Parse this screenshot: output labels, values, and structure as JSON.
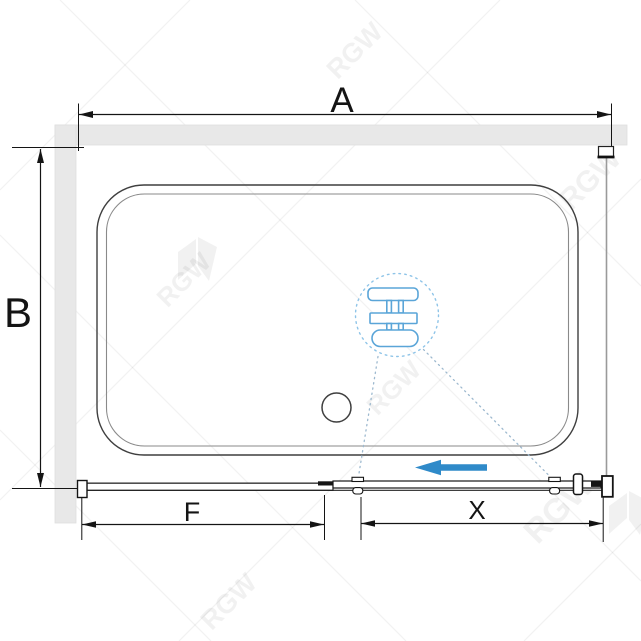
{
  "drawing": {
    "kind": "shower-enclosure-plan-view",
    "labels": {
      "overall_width": "A",
      "overall_depth": "B",
      "fixed_panel": "F",
      "sliding_section": "X"
    },
    "watermark": {
      "text": "RGW"
    },
    "icons": {
      "slide_direction": "arrow-left-icon",
      "detail_bubble": "roller-carriage-detail-icon",
      "drain": "drain-circle-icon"
    },
    "colors": {
      "background": "#ffffff",
      "dimension": "#141414",
      "tray_outline": "#3f3f3f",
      "tray_inner": "#8a8a8a",
      "wall_fill": "#e8e8e8",
      "wall_edge": "#dedede",
      "glass_panel": "#9a9a9a",
      "accent_arrow": "#2f8ac9",
      "roller_detail": "#5aa5d8",
      "detail_circle": "#8ec4e8",
      "leader_dots": "#9db9cf",
      "watermark": "rgba(0,0,0,0.055)"
    }
  }
}
